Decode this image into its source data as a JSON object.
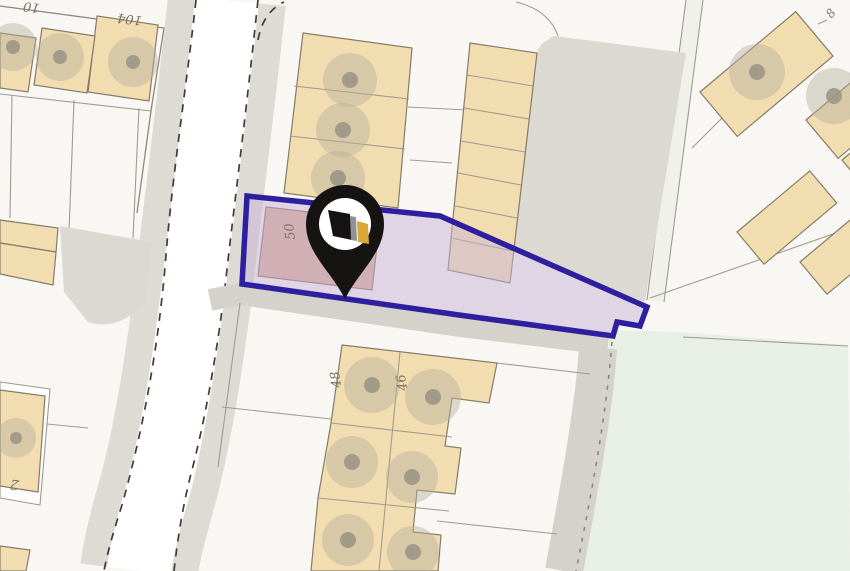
{
  "map": {
    "type": "property-location-plan",
    "labels": {
      "house_partial_top_left": "10",
      "house_104": "104",
      "house_8": "8",
      "plot_50": "50",
      "house_48": "48",
      "house_46": "46",
      "house_2": "2"
    },
    "marker": {
      "name": "property-location-pin"
    },
    "colors": {
      "base": "#f8f7f3",
      "parcel-line": "#a19b90",
      "building-fill": "#f2ddb1",
      "building-stroke": "#857c68",
      "subject-building-fill": "#d9ab95",
      "subject-building-stroke": "#8a6f5c",
      "road-fill": "#ffffff",
      "verge-fill": "#dedbd5",
      "track-fill": "#d5d2cb",
      "hardstanding-fill": "#dcd9d3",
      "green-fill": "#e8efe4",
      "path-green-fill": "#eef2ea",
      "casing-dash": "#3d3c38",
      "tree-ring": "#b5af9d",
      "tree-dot": "#9a9384",
      "plot-outline": "#2d1f9e",
      "plot-fill": "#c7b3d6",
      "pin-black": "#151413",
      "pin-white": "#ffffff",
      "pin-gold": "#d9a839",
      "pin-gray": "#8e9295",
      "label-color": "#7c7365"
    }
  }
}
